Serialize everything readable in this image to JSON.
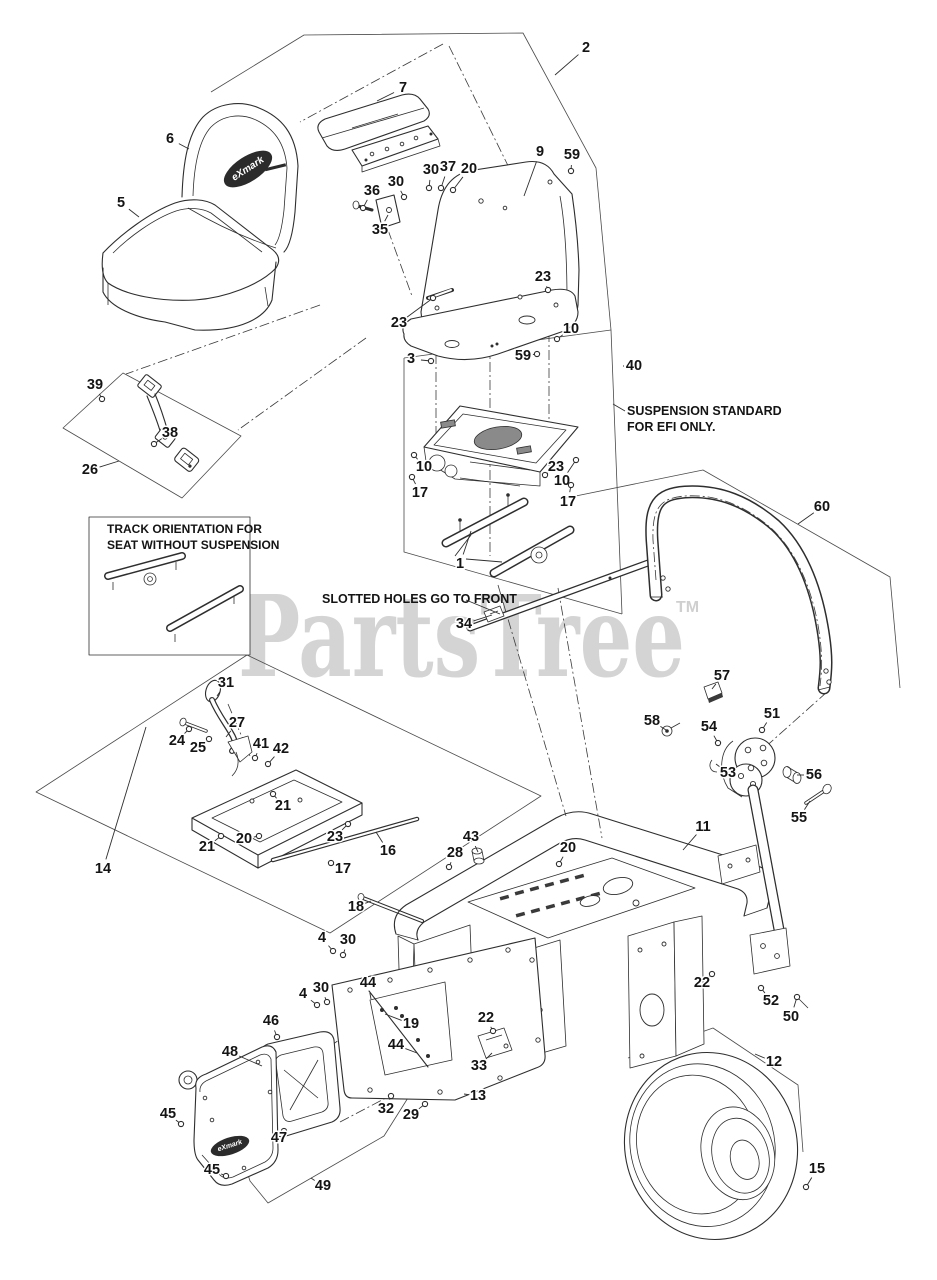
{
  "watermark": {
    "text": "PartsTree",
    "tm": "TM"
  },
  "logo": {
    "text": "eXmark"
  },
  "notes": {
    "suspension": {
      "lines": [
        "SUSPENSION STANDARD",
        "FOR EFI ONLY."
      ]
    },
    "slotted": {
      "text": "SLOTTED HOLES GO TO FRONT"
    },
    "track_box": {
      "lines": [
        "TRACK ORIENTATION FOR",
        "SEAT WITHOUT SUSPENSION"
      ]
    }
  },
  "colors": {
    "line": "#2e2e2e",
    "label": "#141414",
    "watermark": "#d4d4d4",
    "background": "#ffffff"
  },
  "callouts": [
    {
      "n": "2",
      "x": 586,
      "y": 48,
      "tx": 555,
      "ty": 75,
      "d": 0
    },
    {
      "n": "7",
      "x": 403,
      "y": 88,
      "tx": 377,
      "ty": 101,
      "d": 0
    },
    {
      "n": "6",
      "x": 170,
      "y": 139,
      "tx": 189,
      "ty": 149,
      "d": 0
    },
    {
      "n": "5",
      "x": 121,
      "y": 203,
      "tx": 139,
      "ty": 217,
      "d": 0
    },
    {
      "n": "36",
      "x": 372,
      "y": 191,
      "tx": 363,
      "ty": 208,
      "d": 1
    },
    {
      "n": "30",
      "x": 396,
      "y": 182,
      "tx": 404,
      "ty": 197,
      "d": 1
    },
    {
      "n": "35",
      "x": 380,
      "y": 230,
      "tx": 388,
      "ty": 215,
      "d": 0
    },
    {
      "n": "30",
      "x": 431,
      "y": 170,
      "tx": 429,
      "ty": 188,
      "d": 1
    },
    {
      "n": "37",
      "x": 448,
      "y": 167,
      "tx": 441,
      "ty": 188,
      "d": 1
    },
    {
      "n": "20",
      "x": 469,
      "y": 169,
      "tx": 453,
      "ty": 190,
      "d": 1
    },
    {
      "n": "9",
      "x": 540,
      "y": 152,
      "tx": 524,
      "ty": 196,
      "d": 0
    },
    {
      "n": "59",
      "x": 572,
      "y": 155,
      "tx": 571,
      "ty": 171,
      "d": 1
    },
    {
      "n": "23",
      "x": 543,
      "y": 277,
      "tx": 548,
      "ty": 290,
      "d": 1
    },
    {
      "n": "23",
      "x": 399,
      "y": 323,
      "tx": 433,
      "ty": 298,
      "d": 1
    },
    {
      "n": "3",
      "x": 411,
      "y": 359,
      "tx": 431,
      "ty": 361,
      "d": 1
    },
    {
      "n": "59",
      "x": 523,
      "y": 356,
      "tx": 537,
      "ty": 354,
      "d": 1
    },
    {
      "n": "10",
      "x": 571,
      "y": 329,
      "tx": 557,
      "ty": 339,
      "d": 1
    },
    {
      "n": "40",
      "x": 634,
      "y": 366,
      "tx": 623,
      "ty": 366,
      "d": 0
    },
    {
      "n": "39",
      "x": 95,
      "y": 385,
      "tx": 102,
      "ty": 399,
      "d": 1
    },
    {
      "n": "38",
      "x": 170,
      "y": 433,
      "tx": 154,
      "ty": 444,
      "d": 1
    },
    {
      "n": "26",
      "x": 90,
      "y": 470,
      "tx": 119,
      "ty": 461,
      "d": 0
    },
    {
      "n": "10",
      "x": 424,
      "y": 467,
      "tx": 414,
      "ty": 455,
      "d": 1
    },
    {
      "n": "17",
      "x": 420,
      "y": 493,
      "tx": 412,
      "ty": 477,
      "d": 1
    },
    {
      "n": "23",
      "x": 556,
      "y": 467,
      "tx": 545,
      "ty": 475,
      "d": 1
    },
    {
      "n": "10",
      "x": 562,
      "y": 481,
      "tx": 576,
      "ty": 460,
      "d": 1
    },
    {
      "n": "17",
      "x": 568,
      "y": 502,
      "tx": 571,
      "ty": 485,
      "d": 1
    },
    {
      "n": "1",
      "x": 460,
      "y": 564,
      "tx": 471,
      "ty": 531,
      "d": 0
    },
    {
      "n": "34",
      "x": 464,
      "y": 624,
      "tx": 492,
      "ty": 615,
      "d": 0
    },
    {
      "n": "60",
      "x": 822,
      "y": 507,
      "tx": 798,
      "ty": 524,
      "d": 0
    },
    {
      "n": "31",
      "x": 226,
      "y": 683,
      "tx": 217,
      "ty": 696,
      "d": 0
    },
    {
      "n": "27",
      "x": 237,
      "y": 723,
      "tx": 226,
      "ty": 737,
      "d": 0
    },
    {
      "n": "24",
      "x": 177,
      "y": 741,
      "tx": 189,
      "ty": 729,
      "d": 1
    },
    {
      "n": "25",
      "x": 198,
      "y": 748,
      "tx": 209,
      "ty": 739,
      "d": 1
    },
    {
      "n": "41",
      "x": 261,
      "y": 744,
      "tx": 255,
      "ty": 758,
      "d": 1
    },
    {
      "n": "42",
      "x": 281,
      "y": 749,
      "tx": 268,
      "ty": 764,
      "d": 1
    },
    {
      "n": "21",
      "x": 283,
      "y": 806,
      "tx": 273,
      "ty": 794,
      "d": 1
    },
    {
      "n": "20",
      "x": 244,
      "y": 839,
      "tx": 259,
      "ty": 836,
      "d": 1
    },
    {
      "n": "21",
      "x": 207,
      "y": 847,
      "tx": 221,
      "ty": 836,
      "d": 1
    },
    {
      "n": "23",
      "x": 335,
      "y": 837,
      "tx": 348,
      "ty": 824,
      "d": 1
    },
    {
      "n": "16",
      "x": 388,
      "y": 851,
      "tx": 376,
      "ty": 832,
      "d": 0
    },
    {
      "n": "17",
      "x": 343,
      "y": 869,
      "tx": 331,
      "ty": 863,
      "d": 1
    },
    {
      "n": "14",
      "x": 103,
      "y": 869,
      "tx": 146,
      "ty": 727,
      "d": 0
    },
    {
      "n": "18",
      "x": 356,
      "y": 907,
      "tx": 371,
      "ty": 901,
      "d": 0
    },
    {
      "n": "43",
      "x": 471,
      "y": 837,
      "tx": 478,
      "ty": 852,
      "d": 0
    },
    {
      "n": "28",
      "x": 455,
      "y": 853,
      "tx": 449,
      "ty": 867,
      "d": 1
    },
    {
      "n": "20",
      "x": 568,
      "y": 848,
      "tx": 559,
      "ty": 864,
      "d": 1
    },
    {
      "n": "11",
      "x": 703,
      "y": 827,
      "tx": 683,
      "ty": 850,
      "d": 0
    },
    {
      "n": "57",
      "x": 722,
      "y": 676,
      "tx": 712,
      "ty": 689,
      "d": 0
    },
    {
      "n": "58",
      "x": 652,
      "y": 721,
      "tx": 666,
      "ty": 730,
      "d": 0
    },
    {
      "n": "54",
      "x": 709,
      "y": 727,
      "tx": 718,
      "ty": 743,
      "d": 1
    },
    {
      "n": "51",
      "x": 772,
      "y": 714,
      "tx": 762,
      "ty": 730,
      "d": 1
    },
    {
      "n": "53",
      "x": 728,
      "y": 773,
      "tx": 716,
      "ty": 764,
      "d": 0
    },
    {
      "n": "56",
      "x": 814,
      "y": 775,
      "tx": 797,
      "ty": 775,
      "d": 0
    },
    {
      "n": "55",
      "x": 799,
      "y": 818,
      "tx": 810,
      "ty": 801,
      "d": 0
    },
    {
      "n": "52",
      "x": 771,
      "y": 1001,
      "tx": 761,
      "ty": 988,
      "d": 1
    },
    {
      "n": "50",
      "x": 791,
      "y": 1017,
      "tx": 797,
      "ty": 997,
      "d": 1
    },
    {
      "n": "12",
      "x": 774,
      "y": 1062,
      "tx": 755,
      "ty": 1054,
      "d": 0
    },
    {
      "n": "15",
      "x": 817,
      "y": 1169,
      "tx": 806,
      "ty": 1187,
      "d": 1
    },
    {
      "n": "4",
      "x": 322,
      "y": 938,
      "tx": 333,
      "ty": 951,
      "d": 1
    },
    {
      "n": "30",
      "x": 348,
      "y": 940,
      "tx": 343,
      "ty": 955,
      "d": 1
    },
    {
      "n": "4",
      "x": 303,
      "y": 994,
      "tx": 317,
      "ty": 1005,
      "d": 1
    },
    {
      "n": "30",
      "x": 321,
      "y": 988,
      "tx": 327,
      "ty": 1002,
      "d": 1
    },
    {
      "n": "44",
      "x": 368,
      "y": 983,
      "tx": 371,
      "ty": 999,
      "d": 0
    },
    {
      "n": "19",
      "x": 411,
      "y": 1024,
      "tx": 385,
      "ty": 1014,
      "d": 0
    },
    {
      "n": "44",
      "x": 396,
      "y": 1045,
      "tx": 417,
      "ty": 1053,
      "d": 0
    },
    {
      "n": "22",
      "x": 486,
      "y": 1018,
      "tx": 493,
      "ty": 1031,
      "d": 1
    },
    {
      "n": "33",
      "x": 479,
      "y": 1066,
      "tx": 492,
      "ty": 1053,
      "d": 0
    },
    {
      "n": "13",
      "x": 478,
      "y": 1096,
      "tx": 464,
      "ty": 1094,
      "d": 0
    },
    {
      "n": "32",
      "x": 386,
      "y": 1109,
      "tx": 391,
      "ty": 1096,
      "d": 1
    },
    {
      "n": "29",
      "x": 411,
      "y": 1115,
      "tx": 425,
      "ty": 1104,
      "d": 1
    },
    {
      "n": "46",
      "x": 271,
      "y": 1021,
      "tx": 277,
      "ty": 1037,
      "d": 1
    },
    {
      "n": "48",
      "x": 230,
      "y": 1052,
      "tx": 262,
      "ty": 1066,
      "d": 0
    },
    {
      "n": "45",
      "x": 168,
      "y": 1114,
      "tx": 181,
      "ty": 1124,
      "d": 1
    },
    {
      "n": "47",
      "x": 279,
      "y": 1138,
      "tx": 284,
      "ty": 1131,
      "d": 1
    },
    {
      "n": "45",
      "x": 212,
      "y": 1170,
      "tx": 226,
      "ty": 1176,
      "d": 1
    },
    {
      "n": "49",
      "x": 323,
      "y": 1186,
      "tx": 311,
      "ty": 1178,
      "d": 0
    },
    {
      "n": "22",
      "x": 702,
      "y": 983,
      "tx": 712,
      "ty": 974,
      "d": 1
    }
  ]
}
